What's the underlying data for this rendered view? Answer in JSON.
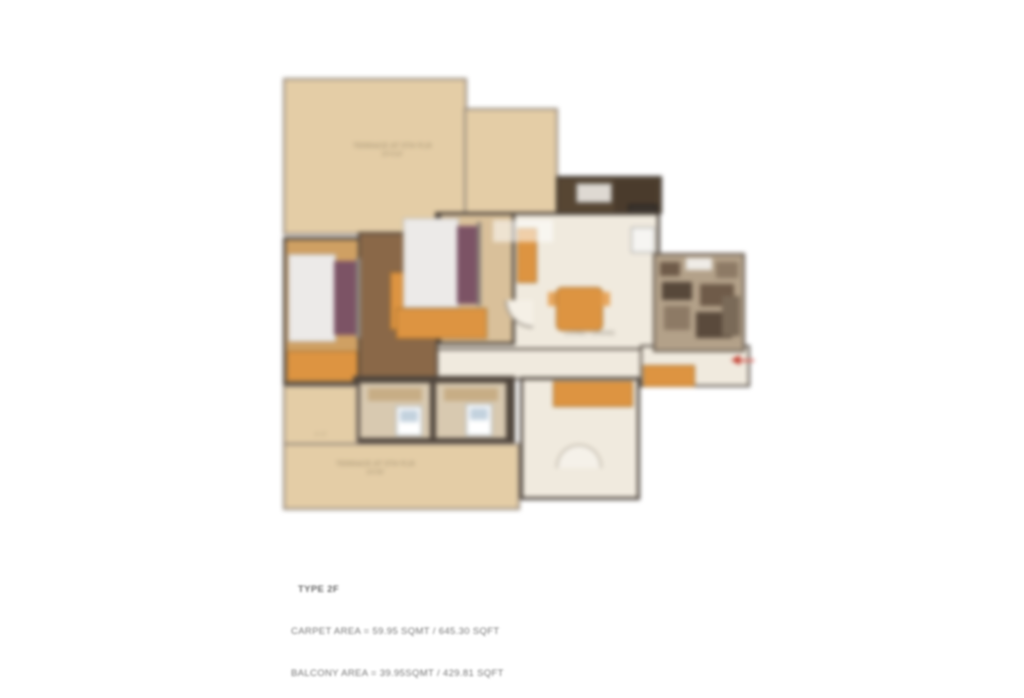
{
  "caption": {
    "type_label": "TYPE 2F",
    "carpet_area_line": "CARPET AREA = 59.95 SQMT / 645.30 SQFT",
    "balcony_area_line": "BALCONY AREA = 39.95SQMT / 429.81 SQFT"
  },
  "rooms": {
    "terrace_top_label": "TERRACE AT 5TH FLR",
    "terrace_top_dim": "20'X15'",
    "terrace_bottom_label": "TERRACE AT 5TH FLR",
    "terrace_bottom_dim": "24'X8'",
    "terrace_bottom_note": "4'-6\"",
    "living_dining_label": "LIVING / DINING"
  },
  "colors": {
    "terrace_beige": "#e4cda6",
    "interior_cream": "#f0eade",
    "wood_brown": "#8a6848",
    "furniture_orange": "#dd9441",
    "wall_dark": "#4d443c",
    "balcony_dark": "#574633",
    "pillow_purple": "#7c5365",
    "entry_red": "#c0392b"
  }
}
